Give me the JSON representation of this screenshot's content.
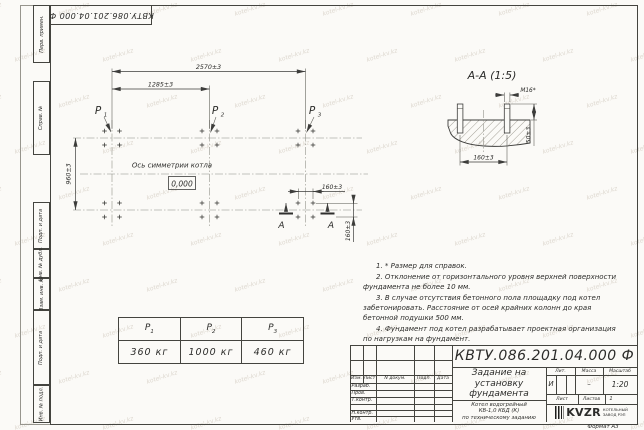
{
  "watermark": {
    "text": "kotel-kv.kz"
  },
  "frame": {
    "corner_stamp": "КВТУ.086.201.04.000  Ф",
    "sidebar_labels": [
      "Перв. примен.",
      "Справ. №",
      "Подп. и дата",
      "Инв. № дубл.",
      "Взам. инв. №",
      "Подп. и дата",
      "Инв. № подл."
    ],
    "format_label": "Формат А3"
  },
  "plan": {
    "dim_overall": "2570±3",
    "dim_half": "1285±3",
    "dim_depth": "960±3",
    "dim_bolt_h": "160±3",
    "dim_bolt_v": "160±3",
    "axis_label": "Ось симметрии котла",
    "level_mark": "0,000",
    "loads": [
      {
        "base": "P",
        "sub": "1"
      },
      {
        "base": "P",
        "sub": "2"
      },
      {
        "base": "P",
        "sub": "3"
      }
    ],
    "section_letter": "А"
  },
  "section": {
    "title": "А-А (1:5)",
    "thread_label": "М16*",
    "dim_width": "160±3",
    "dim_height": "50±3"
  },
  "notes": [
    "1. * Размер для справок.",
    "2. Отклонение от горизонтального уровня верхней поверхности фундамента не более 10 мм.",
    "3. В случае отсутствия бетонного пола площадку под котел забетонировать. Расстояние от осей крайних колонн до края бетонной подушки 500 мм.",
    "4. Фундамент под котел разрабатывает проектная организация по нагрузкам на фундамент."
  ],
  "load_table": {
    "headers": [
      {
        "base": "P",
        "sub": "1"
      },
      {
        "base": "P",
        "sub": "2"
      },
      {
        "base": "P",
        "sub": "3"
      }
    ],
    "values": [
      "360 кг",
      "1000 кг",
      "460 кг"
    ]
  },
  "title_block": {
    "doc_number": "КВТУ.086.201.04.000  Ф",
    "title_lines": [
      "Задание на",
      "установку",
      "фундамента"
    ],
    "subtitle_lines": [
      "Котел водогрейный",
      "КВ-1,0 КБД (К)",
      "по техническому заданию"
    ],
    "rev_headers": [
      "Изм.",
      "Лист",
      "N докум.",
      "Подп.",
      "Дата"
    ],
    "sign_rows": [
      "Разраб.",
      "Пров.",
      "Т.контр.",
      "Н.контр.",
      "Утв."
    ],
    "lit_header": "Лит.",
    "mass_header": "Масса",
    "scale_header": "Масштаб",
    "lit_value": "И",
    "mass_value": "–",
    "scale_value": "1:20",
    "sheet_label": "Лист",
    "sheets_label": "Листов",
    "sheets_value": "1",
    "logo_text": "KVZR",
    "logo_caption": [
      "КОТЕЛЬНЫЙ",
      "ЗАВОД РЭП"
    ]
  }
}
